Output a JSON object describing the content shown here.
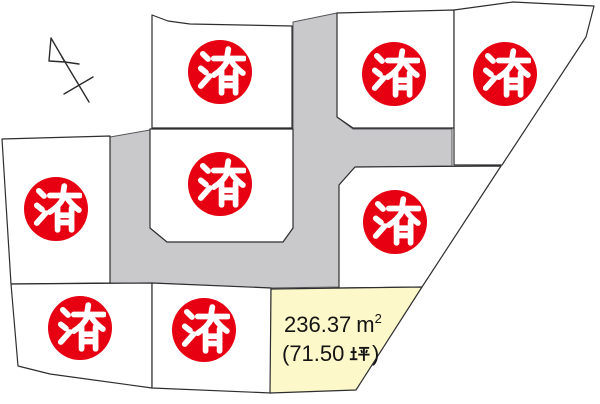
{
  "labels": {
    "sold": "済"
  },
  "available_lot": {
    "area_label": "236.37 ㎡",
    "area_number": "236.37",
    "area_unit_base": "m",
    "area_unit_sup": "2",
    "tsubo_label": "（71.50 坪）",
    "tsubo_open": "(71.50",
    "tsubo_unit": "坪",
    "tsubo_close": ")"
  },
  "lots": [
    {
      "position": "top-left",
      "status": "sold",
      "stamp": "済"
    },
    {
      "position": "top-center",
      "status": "sold",
      "stamp": "済"
    },
    {
      "position": "top-right",
      "status": "sold",
      "stamp": "済"
    },
    {
      "position": "middle-left",
      "status": "sold",
      "stamp": "済"
    },
    {
      "position": "middle-center",
      "status": "sold",
      "stamp": "済"
    },
    {
      "position": "middle-right",
      "status": "sold",
      "stamp": "済"
    },
    {
      "position": "bottom-left",
      "status": "sold",
      "stamp": "済"
    },
    {
      "position": "bottom-center",
      "status": "sold",
      "stamp": "済"
    },
    {
      "position": "bottom-right",
      "status": "available",
      "area_label": "236.37 ㎡",
      "tsubo_label": "（71.50 坪）"
    }
  ],
  "colors": {
    "sold_red": "#e60012",
    "road_gray": "#c9c9cb",
    "lot_fill": "#ffffff",
    "available_fill": "#fcf8ca",
    "outline": "#2e2e30"
  },
  "compass": {
    "type": "north-arrow"
  }
}
